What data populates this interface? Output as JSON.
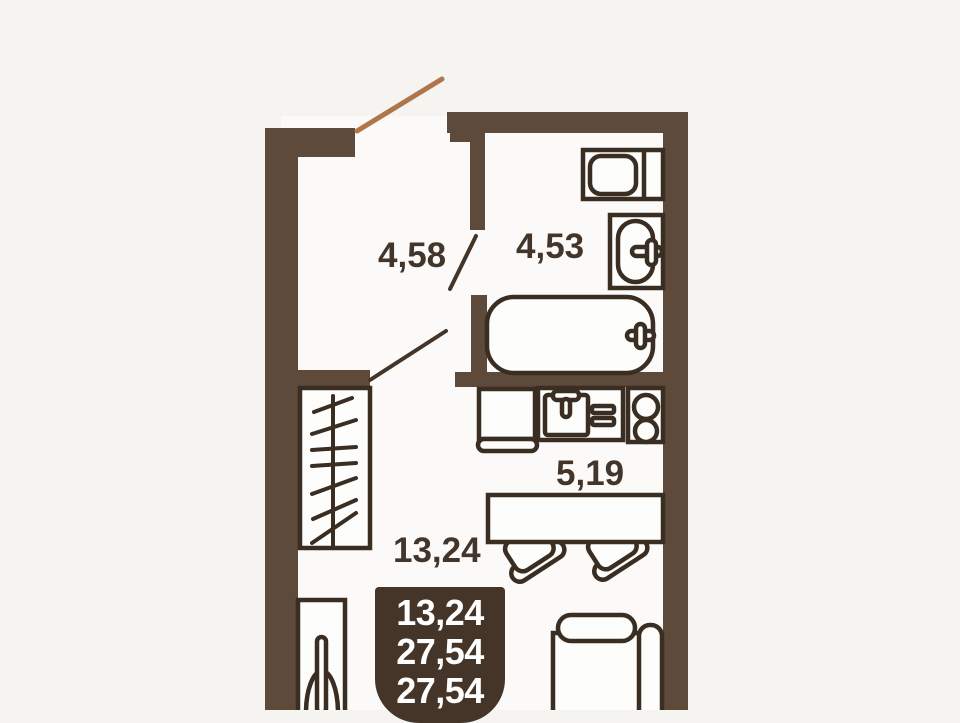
{
  "floorplan": {
    "type": "studio-apartment-floor-plan",
    "rooms": [
      {
        "id": "hallway",
        "area": "4,58"
      },
      {
        "id": "bathroom",
        "area": "4,53"
      },
      {
        "id": "kitchen",
        "area": "5,19"
      },
      {
        "id": "living-room",
        "area": "13,24"
      }
    ],
    "summary": {
      "values": [
        "13,24",
        "27,54",
        "27,54"
      ]
    },
    "colors": {
      "background": "#f5f4f1",
      "floor": "#fbfaf8",
      "wall": "#5d4a3a",
      "fixture_stroke": "#3a2d22",
      "interior_door": "#43352a",
      "entry_door": "#b1754b",
      "badge_background": "#453428",
      "badge_text": "#ffffff",
      "label_text": "#44352a"
    },
    "fixtures": [
      "entry-door",
      "toilet",
      "bathroom-sink",
      "bathtub",
      "fridge",
      "kitchen-sink-counter",
      "stove",
      "wardrobe",
      "dining-table",
      "chairs",
      "bed",
      "floor-cabinet"
    ]
  }
}
